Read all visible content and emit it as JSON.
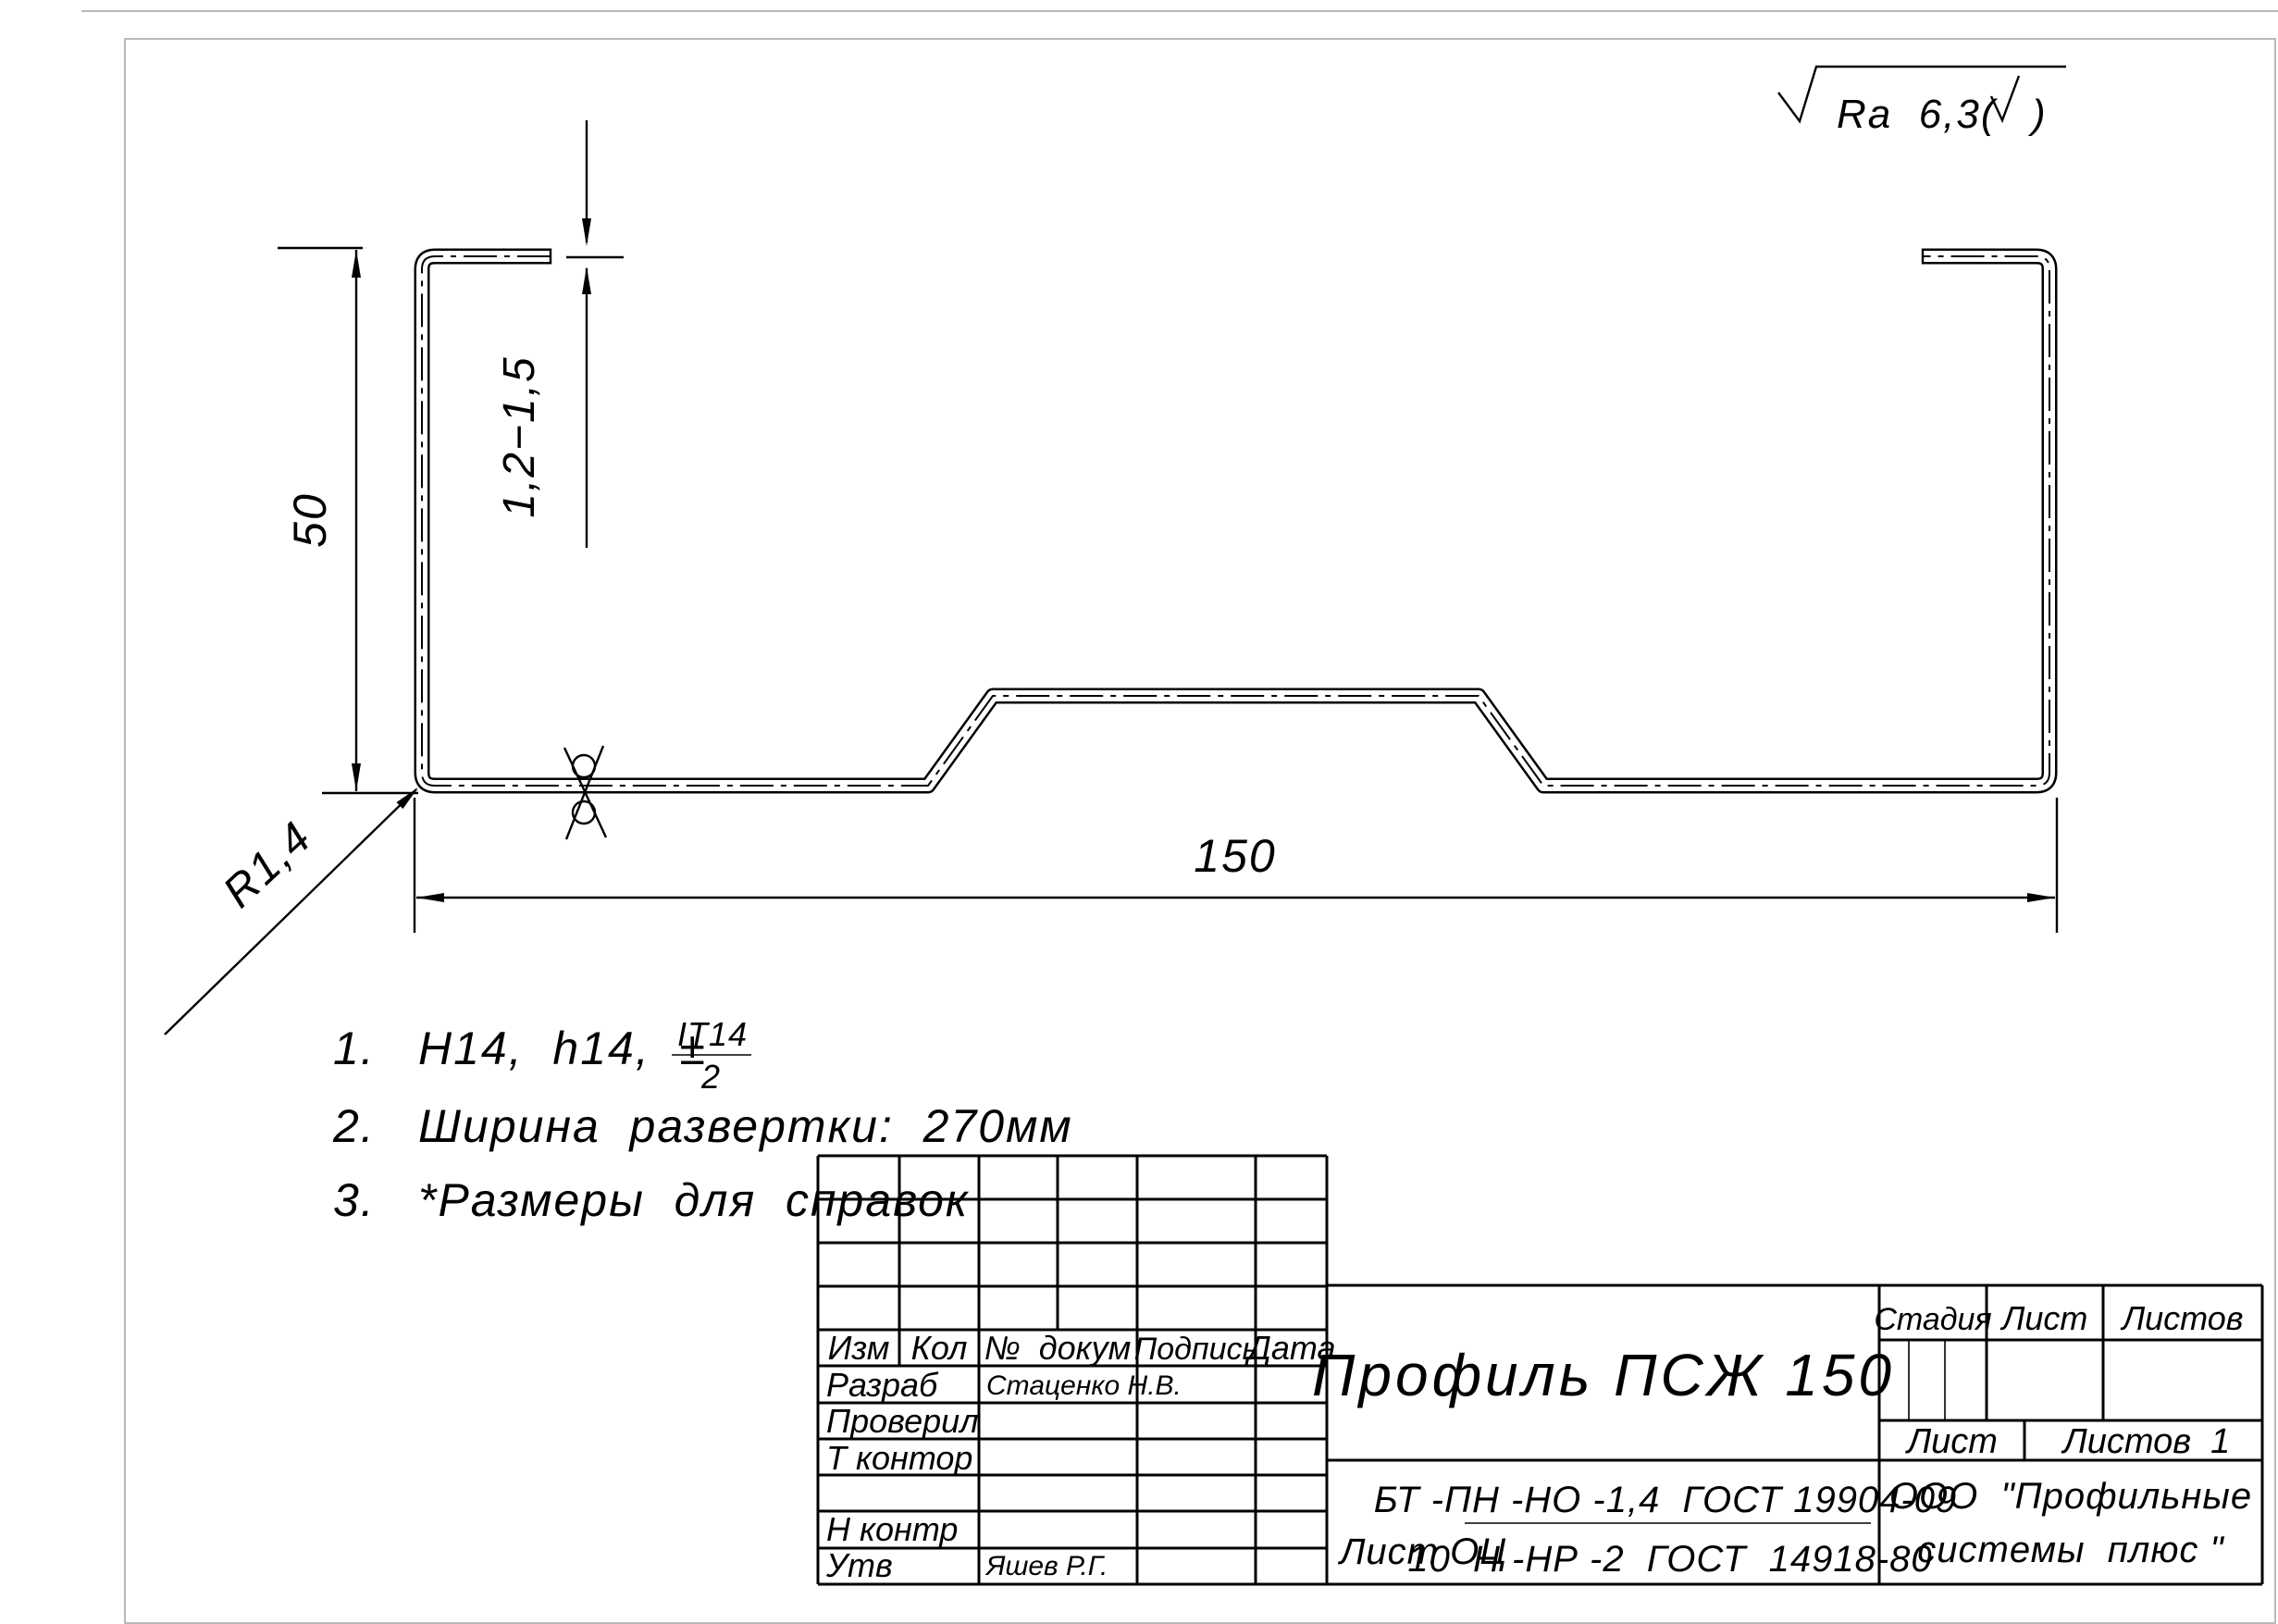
{
  "drawing": {
    "roughness": {
      "label": "Ra  6,3(",
      "close": ")"
    },
    "dimensions": {
      "height": "50",
      "thickness": "1,2−1,5",
      "width": "150",
      "radius": "R1,4"
    },
    "notes": {
      "n1": "1.",
      "t1": "H14,  h14,  ±",
      "frac_top": "IT14",
      "frac_bot": "2",
      "n2": "2.",
      "t2": "Ширина  развертки:  270мм",
      "n3": "3.",
      "t3": "*Размеры  для  справок"
    }
  },
  "title_block": {
    "rev_cols": {
      "izm": "Изм",
      "kol": "Кол",
      "doc": "№  докум",
      "sign": "Подпись",
      "date": "Дата"
    },
    "rows": {
      "r1": "Разраб",
      "r1name": "Стаценко Н.В.",
      "r2": "Проверил",
      "r3": "Т контор",
      "r4": "Н контр",
      "r5": "Утв",
      "r5name": "Яшев Р.Г."
    },
    "title": "Профиль ПСЖ 150",
    "material": {
      "prefix": "Лист ОЦ",
      "top": "БТ -ПН -НО -1,4  ГОСТ 19904-09",
      "bottom": "10  Н -НР -2  ГОСТ  14918-80"
    },
    "stage_header": {
      "stage": "Стадия",
      "sheet": "Лист",
      "sheets": "Листов"
    },
    "bottom_strip": {
      "sheet": "Лист",
      "sheets": "Листов  1"
    },
    "company1": "ООО  \"Профильные",
    "company2": "системы  плюс \""
  }
}
